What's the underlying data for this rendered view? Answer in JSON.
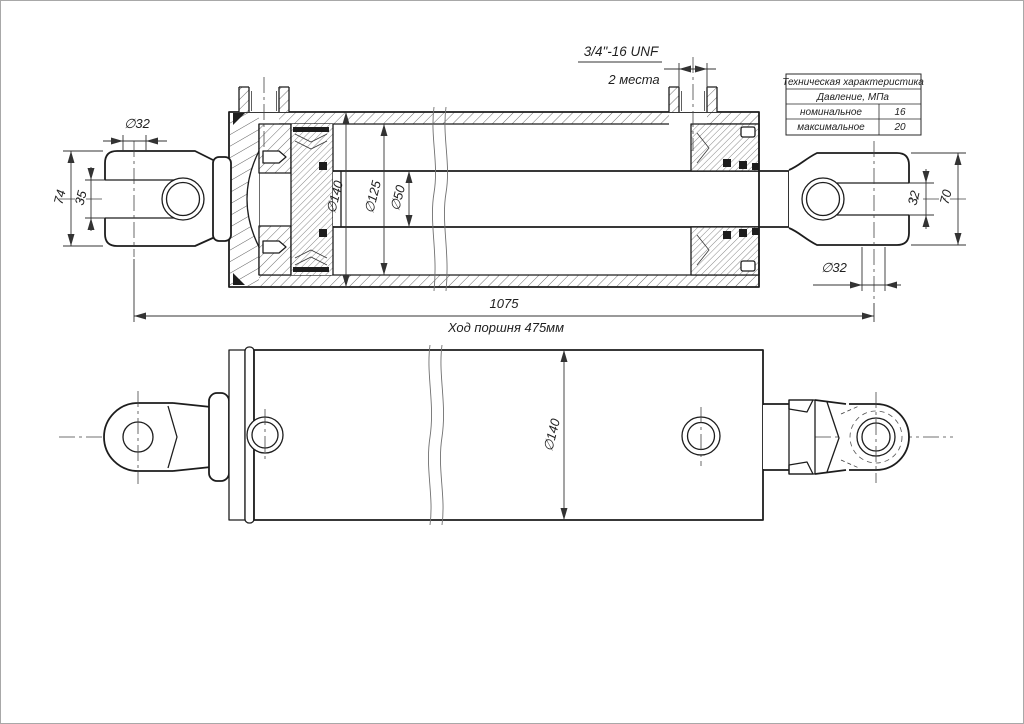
{
  "drawing_title": "Гидроцилиндр — сборочный чертёж",
  "colors": {
    "line": "#1d1d1d",
    "thin_line": "#3a3a3a",
    "background": "#ffffff",
    "page_border": "#a8a8a8"
  },
  "section_view": {
    "thread_callout": {
      "spec": "3/4\"-16 UNF",
      "places": "2 места"
    },
    "dims": {
      "eye_bore_left": "∅32",
      "clevis_width_left": "74",
      "slot_width_left": "35",
      "barrel_od": "∅140",
      "barrel_bore": "∅125",
      "rod_dia": "∅50",
      "slot_width_right": "32",
      "clevis_width_right": "70",
      "eye_bore_right": "∅32",
      "overall_length": "1075",
      "stroke_note": "Ход поршня 475мм"
    }
  },
  "plan_view": {
    "dims": {
      "body_od": "∅140"
    }
  },
  "spec_table": {
    "title": "Техническая характеристика",
    "subtitle": "Давление, МПа",
    "rows": [
      {
        "label": "номинальное",
        "value": "16"
      },
      {
        "label": "максимальное",
        "value": "20"
      }
    ]
  }
}
